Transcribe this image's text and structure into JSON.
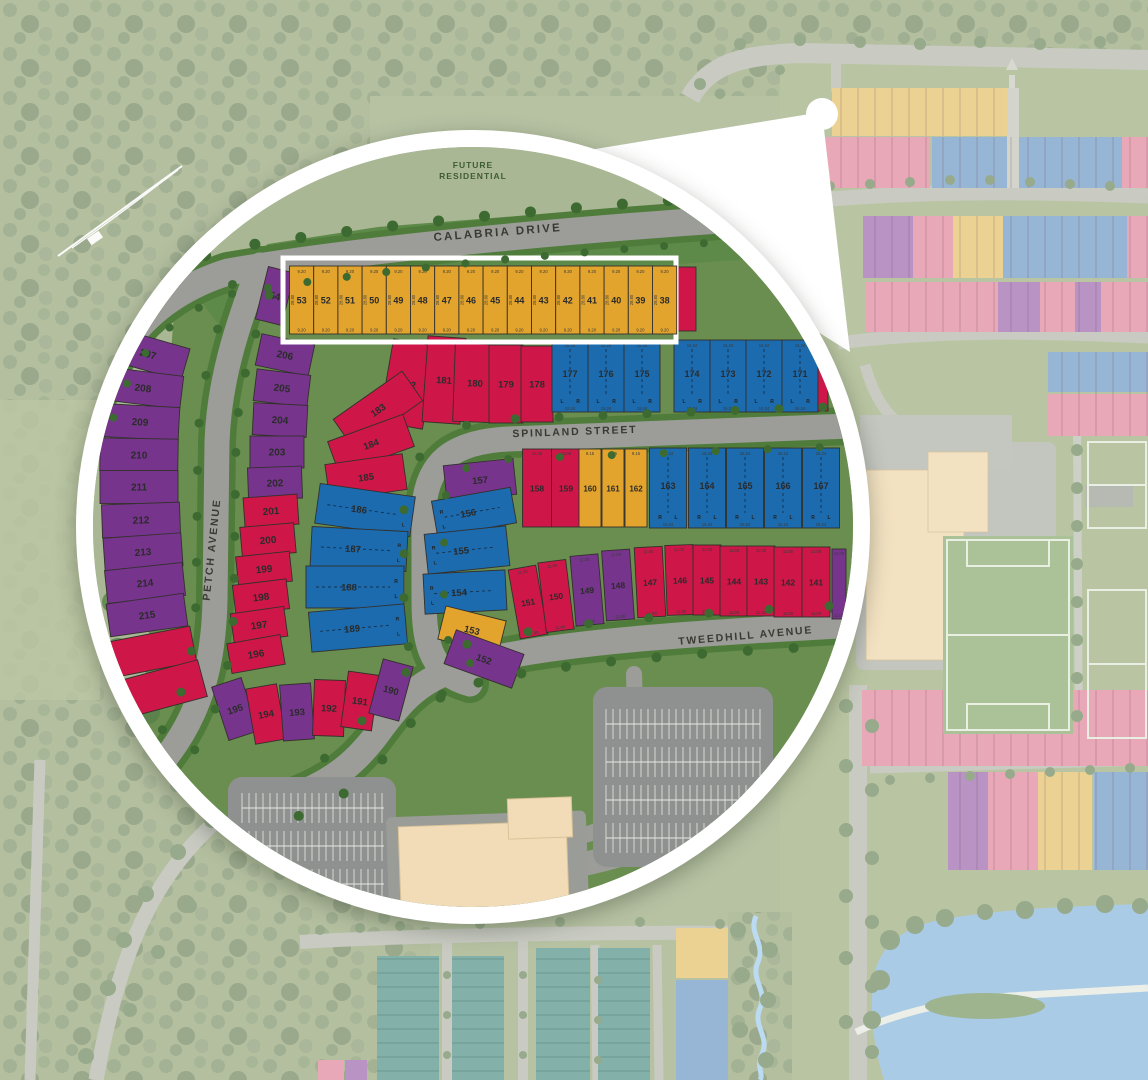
{
  "palette": {
    "red": "#ce1748",
    "purple": "#76348c",
    "blue": "#1c6bae",
    "yellow": "#e2a42d",
    "road": "#9c9d99",
    "road_casing_green": "#507c3b",
    "tree_green": "#3c6a31",
    "dev_green": "#6a8e4f",
    "future_green": "#5e8a49",
    "sage": "#a9b794",
    "highlight_frame": "#ffffff",
    "building_beige": "#f2dcb8",
    "parking_gray": "#8f9190",
    "pond_blue": "#a9cbe6",
    "bg_pink": "#e9a8b7",
    "bg_blue": "#97b6d6",
    "bg_purple": "#b893c4",
    "bg_yellow": "#ecd292",
    "bg_teal": "#83b1aa"
  },
  "area_labels": {
    "future_residential_line1": "FUTURE",
    "future_residential_line2": "RESIDENTIAL"
  },
  "streets": {
    "calabria": "CALABRIA DRIVE",
    "spinland": "SPINLAND STREET",
    "tweedhill": "TWEEDHILL AVENUE",
    "petch": "PETCH AVENUE"
  },
  "dims": {
    "yellow_width": "9.20",
    "yellow_depth": "28.80",
    "semi_width": "15.24",
    "mid_red_width": "11.08",
    "mid_yellow_width": "9.15",
    "south_red_width": "11.00",
    "semi_left": "L",
    "semi_right": "R"
  },
  "highlight_row": {
    "frame": {
      "x": 205,
      "y": 126,
      "w": 393,
      "h": 84
    },
    "cell": {
      "y": 134,
      "h": 68,
      "w": 24.2,
      "x0": 211.5
    },
    "lots": [
      "53",
      "52",
      "51",
      "50",
      "49",
      "48",
      "47",
      "46",
      "45",
      "44",
      "43",
      "42",
      "41",
      "40",
      "39",
      "38"
    ]
  },
  "lot_groups": [
    {
      "name": "lot-54",
      "color": "P",
      "s": 10,
      "cells": [
        {
          "n": "54",
          "x": 197,
          "y": 164,
          "w": 27,
          "h": 54,
          "r": 14
        }
      ]
    },
    {
      "name": "calabria-east-sliver",
      "color": "R",
      "cells": [
        {
          "x": 609,
          "y": 167,
          "w": 18,
          "h": 64
        }
      ]
    },
    {
      "name": "west-petch",
      "color": "P",
      "w": 78,
      "h": 33,
      "s": 10,
      "cells": [
        {
          "n": "207",
          "x": 70,
          "y": 222,
          "r": 16
        },
        {
          "n": "208",
          "x": 65,
          "y": 256,
          "r": 7
        },
        {
          "n": "209",
          "x": 62,
          "y": 290,
          "r": 3
        },
        {
          "n": "210",
          "x": 61,
          "y": 323,
          "r": 1
        },
        {
          "n": "211",
          "x": 61,
          "y": 355,
          "r": 0
        },
        {
          "n": "212",
          "x": 63,
          "y": 388,
          "r": -2
        },
        {
          "n": "213",
          "x": 65,
          "y": 420,
          "r": -4
        },
        {
          "n": "214",
          "x": 67,
          "y": 451,
          "r": -6
        },
        {
          "n": "215",
          "x": 69,
          "y": 483,
          "r": -8
        }
      ]
    },
    {
      "name": "west-petch-south",
      "color": "R",
      "cells": [
        {
          "x": 73,
          "y": 520,
          "w": 86,
          "h": 36,
          "r": -11
        },
        {
          "x": 80,
          "y": 558,
          "w": 92,
          "h": 38,
          "r": -15
        }
      ]
    },
    {
      "name": "east-petch",
      "color": "P",
      "w": 54,
      "h": 32,
      "s": 10,
      "cells": [
        {
          "n": "206",
          "x": 207,
          "y": 223,
          "r": 12
        },
        {
          "n": "205",
          "x": 204,
          "y": 256,
          "r": 7
        },
        {
          "n": "204",
          "x": 202,
          "y": 288,
          "r": 3
        },
        {
          "n": "203",
          "x": 199,
          "y": 320,
          "r": 0
        },
        {
          "n": "202",
          "x": 197,
          "y": 351,
          "r": -2
        }
      ]
    },
    {
      "name": "east-petch-red",
      "color": "R",
      "w": 54,
      "h": 30,
      "s": 10,
      "cells": [
        {
          "n": "201",
          "x": 193,
          "y": 379,
          "r": -4
        },
        {
          "n": "200",
          "x": 190,
          "y": 408,
          "r": -5
        },
        {
          "n": "199",
          "x": 186,
          "y": 437,
          "r": -6
        },
        {
          "n": "198",
          "x": 183,
          "y": 465,
          "r": -7
        },
        {
          "n": "197",
          "x": 181,
          "y": 493,
          "r": -8
        },
        {
          "n": "196",
          "x": 178,
          "y": 522,
          "r": -10
        }
      ]
    },
    {
      "name": "south-arc",
      "w": 31,
      "h": 56,
      "s": 9.5,
      "cells": [
        {
          "n": "195",
          "x": 157,
          "y": 577,
          "r": -18,
          "c": "P"
        },
        {
          "n": "194",
          "x": 188,
          "y": 582,
          "r": -10,
          "c": "R"
        },
        {
          "n": "193",
          "x": 219,
          "y": 580,
          "r": -4,
          "c": "P"
        },
        {
          "n": "192",
          "x": 251,
          "y": 576,
          "r": 2,
          "c": "R"
        },
        {
          "n": "191",
          "x": 282,
          "y": 569,
          "r": 8,
          "c": "R"
        },
        {
          "n": "190",
          "x": 313,
          "y": 558,
          "r": 15,
          "c": "P"
        }
      ]
    },
    {
      "name": "red-fan",
      "color": "R",
      "s": 9.5,
      "cells": [
        {
          "n": "182",
          "x": 330,
          "y": 252,
          "w": 44,
          "h": 84,
          "r": 10
        },
        {
          "n": "181",
          "x": 366,
          "y": 248,
          "w": 38,
          "h": 86,
          "r": 4
        },
        {
          "n": "183",
          "x": 300,
          "y": 278,
          "w": 84,
          "h": 36,
          "r": -35
        },
        {
          "n": "184",
          "x": 293,
          "y": 312,
          "w": 80,
          "h": 34,
          "r": -20
        },
        {
          "n": "185",
          "x": 288,
          "y": 345,
          "w": 78,
          "h": 36,
          "r": -8
        }
      ]
    },
    {
      "name": "north-red-row",
      "color": "R",
      "s": 9.5,
      "cells": [
        {
          "n": "180",
          "x": 397,
          "y": 251,
          "w": 42,
          "h": 78,
          "r": 2
        },
        {
          "n": "179",
          "x": 428,
          "y": 252,
          "w": 34,
          "h": 78
        },
        {
          "n": "178",
          "x": 459,
          "y": 252,
          "w": 32,
          "h": 76
        }
      ]
    },
    {
      "name": "north-semis",
      "color": "B",
      "type": "sv",
      "w": 36,
      "h": 72,
      "s": 9,
      "lr": [
        "L",
        "R"
      ],
      "d1": "15.24",
      "d2": "15.24",
      "cells": [
        {
          "n": "177",
          "x": 492,
          "y": 244
        },
        {
          "n": "176",
          "x": 528,
          "y": 244
        },
        {
          "n": "175",
          "x": 564,
          "y": 244
        },
        {
          "n": "174",
          "x": 614,
          "y": 244
        },
        {
          "n": "173",
          "x": 650,
          "y": 244
        },
        {
          "n": "172",
          "x": 686,
          "y": 244
        },
        {
          "n": "171",
          "x": 722,
          "y": 244
        }
      ]
    },
    {
      "name": "north-semis-end",
      "color": "R",
      "cells": [
        {
          "x": 745,
          "y": 244,
          "w": 10,
          "h": 70
        }
      ]
    },
    {
      "name": "center-semis",
      "color": "B",
      "type": "sh",
      "w": 96,
      "h": 40,
      "s": 9.5,
      "lrpos": "right",
      "cells": [
        {
          "n": "186",
          "x": 287,
          "y": 378,
          "r": 8
        },
        {
          "n": "187",
          "x": 281,
          "y": 417,
          "r": 3
        },
        {
          "n": "188",
          "x": 277,
          "y": 455,
          "w": 98,
          "h": 42
        },
        {
          "n": "189",
          "x": 280,
          "y": 496,
          "r": -5
        }
      ]
    },
    {
      "name": "mid-col",
      "s": 9.5,
      "cells": [
        {
          "n": "157",
          "x": 402,
          "y": 348,
          "w": 70,
          "h": 36,
          "r": -6,
          "c": "P"
        },
        {
          "n": "156",
          "x": 396,
          "y": 380,
          "w": 80,
          "h": 36,
          "r": -10,
          "c": "B",
          "t": "sh",
          "lrpos": "left"
        },
        {
          "n": "155",
          "x": 389,
          "y": 418,
          "w": 82,
          "h": 40,
          "r": -6,
          "c": "B",
          "t": "sh",
          "lrpos": "left"
        },
        {
          "n": "154",
          "x": 387,
          "y": 460,
          "w": 82,
          "h": 40,
          "r": -3,
          "c": "B",
          "t": "sh",
          "lrpos": "left"
        },
        {
          "n": "153",
          "x": 394,
          "y": 498,
          "w": 62,
          "h": 34,
          "r": 14,
          "c": "Y"
        },
        {
          "n": "152",
          "x": 406,
          "y": 527,
          "w": 72,
          "h": 36,
          "r": 20,
          "c": "P"
        }
      ]
    },
    {
      "name": "mid-row-red",
      "color": "R",
      "w": 29,
      "h": 78,
      "s": 8.5,
      "d1": "11.08",
      "cells": [
        {
          "n": "158",
          "x": 459,
          "y": 356
        },
        {
          "n": "159",
          "x": 488,
          "y": 356
        }
      ]
    },
    {
      "name": "mid-row-yellow",
      "color": "Y",
      "w": 22,
      "h": 78,
      "s": 8,
      "d1": "9.15",
      "cells": [
        {
          "n": "160",
          "x": 512,
          "y": 356
        },
        {
          "n": "161",
          "x": 535,
          "y": 356
        },
        {
          "n": "162",
          "x": 558,
          "y": 356
        }
      ]
    },
    {
      "name": "mid-row-semis",
      "color": "B",
      "type": "sv",
      "w": 37,
      "h": 80,
      "s": 9,
      "lr": [
        "R",
        "L"
      ],
      "d1": "15.24",
      "d2": "15.24",
      "cells": [
        {
          "n": "163",
          "x": 590,
          "y": 356
        },
        {
          "n": "164",
          "x": 629,
          "y": 356
        },
        {
          "n": "165",
          "x": 667,
          "y": 356
        },
        {
          "n": "166",
          "x": 705,
          "y": 356
        },
        {
          "n": "167",
          "x": 743,
          "y": 356
        }
      ]
    },
    {
      "name": "south-row",
      "w": 28,
      "h": 70,
      "s": 8.5,
      "d1": "11.00",
      "d2": "11.00",
      "cells": [
        {
          "n": "151",
          "x": 450,
          "y": 470,
          "r": -10,
          "c": "R"
        },
        {
          "n": "150",
          "x": 478,
          "y": 464,
          "r": -7,
          "c": "R"
        },
        {
          "n": "149",
          "x": 509,
          "y": 458,
          "r": -5,
          "c": "P"
        },
        {
          "n": "148",
          "x": 540,
          "y": 453,
          "r": -4,
          "c": "P"
        },
        {
          "n": "147",
          "x": 572,
          "y": 450,
          "r": -3,
          "c": "R"
        },
        {
          "n": "146",
          "x": 602,
          "y": 448,
          "r": -2,
          "c": "R"
        },
        {
          "n": "145",
          "x": 629,
          "y": 448,
          "c": "R"
        },
        {
          "n": "144",
          "x": 656,
          "y": 449,
          "c": "R"
        },
        {
          "n": "143",
          "x": 683,
          "y": 449,
          "c": "R"
        },
        {
          "n": "142",
          "x": 710,
          "y": 450,
          "c": "R"
        },
        {
          "n": "141",
          "x": 738,
          "y": 450,
          "c": "R"
        },
        {
          "x": 761,
          "y": 452,
          "w": 14,
          "c": "P"
        }
      ]
    }
  ]
}
